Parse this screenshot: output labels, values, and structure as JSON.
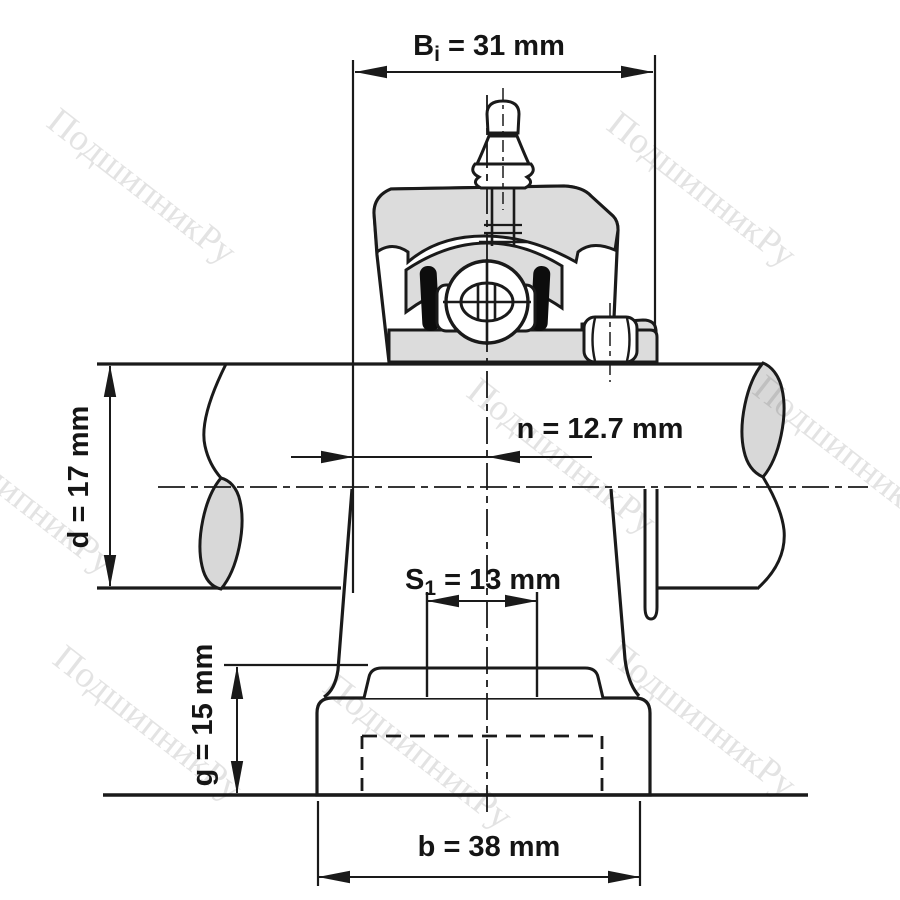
{
  "diagram": {
    "subject": "pillow block bearing unit cross-section with dimensions",
    "units": "mm"
  },
  "dims": {
    "bi": {
      "base": "B",
      "sub": "i",
      "rest": " = 31 mm",
      "value": 31,
      "unit": "mm"
    },
    "n": {
      "text": "n = 12.7 mm",
      "value": 12.7,
      "unit": "mm"
    },
    "d": {
      "text": "d = 17 mm",
      "value": 17,
      "unit": "mm"
    },
    "s1": {
      "base": "S",
      "sub": "1",
      "rest": " = 13 mm",
      "value": 13,
      "unit": "mm"
    },
    "g": {
      "text": "g = 15 mm",
      "value": 15,
      "unit": "mm"
    },
    "b": {
      "text": "b = 38 mm",
      "value": 38,
      "unit": "mm"
    }
  },
  "watermark": {
    "text": "ПодшипникРу",
    "color": "#e3e3e3"
  },
  "colors": {
    "line": "#1a1a1a",
    "section_gray": "#dcdcdc",
    "break_gray": "#d8d8d8",
    "background": "#ffffff"
  }
}
